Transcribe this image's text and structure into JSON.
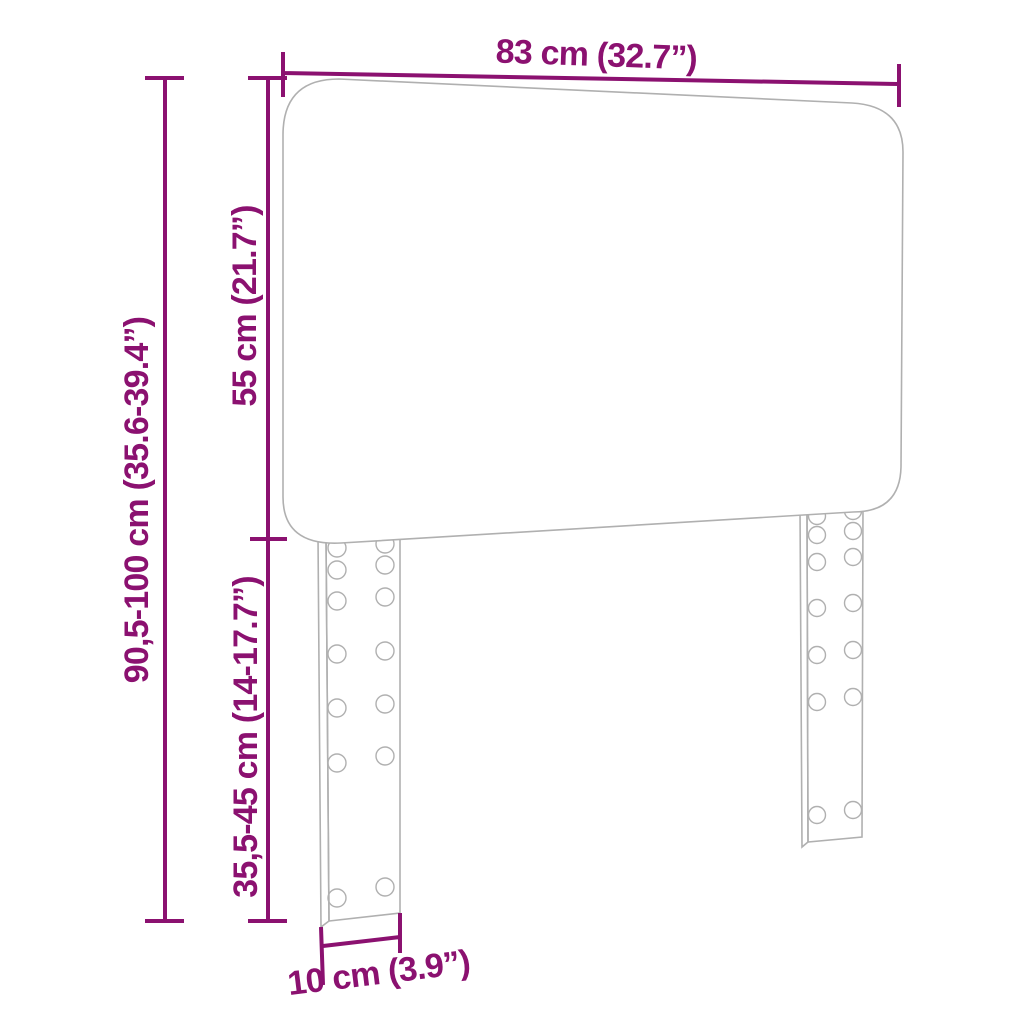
{
  "diagram": {
    "subject": "headboard-with-adjustable-legs",
    "dimensions": {
      "width_label": "83 cm (32.7”)",
      "total_height_label": "90,5-100 cm (35.6-39.4”)",
      "panel_height_label": "55 cm (21.7”)",
      "leg_height_label": "35,5-45 cm (14-17.7”)",
      "leg_width_label": "10 cm (3.9”)"
    },
    "colors": {
      "dimension_color": "#8b1170",
      "outline_color": "#b0b0b0",
      "background_color": "#ffffff"
    }
  }
}
